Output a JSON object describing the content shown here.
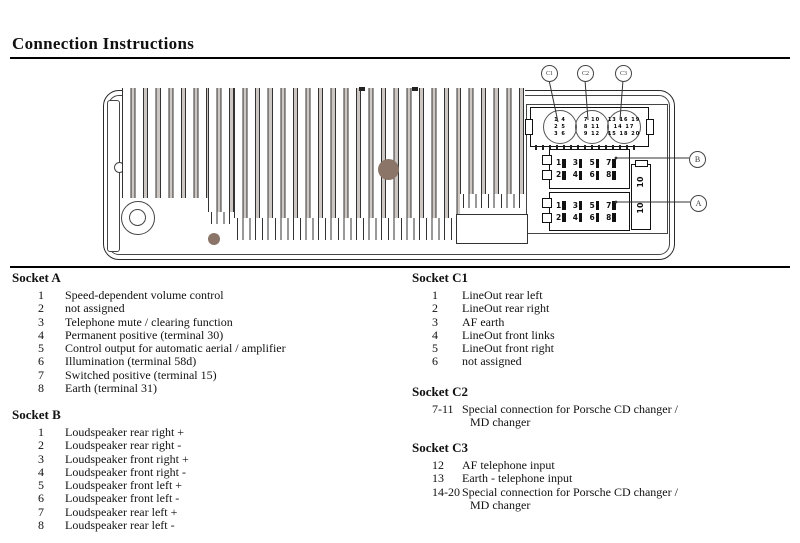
{
  "title": "Connection Instructions",
  "diagram": {
    "callout_c1": "C1",
    "callout_c2": "C2",
    "callout_c3": "C3",
    "callout_b": "B",
    "callout_a": "A",
    "fuse_top": "10",
    "fuse_bottom": "10",
    "socket_b": {
      "row1": [
        "1",
        "3",
        "5",
        "7"
      ],
      "row2": [
        "2",
        "4",
        "6",
        "8"
      ]
    },
    "socket_a": {
      "row1": [
        "1",
        "3",
        "5",
        "7"
      ],
      "row2": [
        "2",
        "4",
        "6",
        "8"
      ]
    },
    "c1": {
      "r1": "1 4",
      "r2": "2 5",
      "r3": "3 6"
    },
    "c2": {
      "r1": "7 10",
      "r2": "8 11",
      "r3": "9 12"
    },
    "c3": {
      "r1": "13 16 19",
      "r2": "14 17",
      "r3": "15 18 20"
    }
  },
  "sections": {
    "socket_a": {
      "title": "Socket A",
      "items": [
        {
          "pin": "1",
          "desc": "Speed-dependent volume control"
        },
        {
          "pin": "2",
          "desc": "not assigned"
        },
        {
          "pin": "3",
          "desc": "Telephone mute / clearing function"
        },
        {
          "pin": "4",
          "desc": "Permanent positive (terminal 30)"
        },
        {
          "pin": "5",
          "desc": "Control output for automatic aerial / amplifier"
        },
        {
          "pin": "6",
          "desc": "Illumination (terminal 58d)"
        },
        {
          "pin": "7",
          "desc": "Switched positive (terminal 15)"
        },
        {
          "pin": "8",
          "desc": "Earth (terminal 31)"
        }
      ]
    },
    "socket_b": {
      "title": "Socket B",
      "items": [
        {
          "pin": "1",
          "desc": "Loudspeaker rear right +"
        },
        {
          "pin": "2",
          "desc": "Loudspeaker rear right -"
        },
        {
          "pin": "3",
          "desc": "Loudspeaker front right +"
        },
        {
          "pin": "4",
          "desc": "Loudspeaker front right -"
        },
        {
          "pin": "5",
          "desc": "Loudspeaker front left +"
        },
        {
          "pin": "6",
          "desc": "Loudspeaker front left -"
        },
        {
          "pin": "7",
          "desc": "Loudspeaker rear left +"
        },
        {
          "pin": "8",
          "desc": "Loudspeaker rear left -"
        }
      ]
    },
    "socket_c1": {
      "title": "Socket C1",
      "items": [
        {
          "pin": "1",
          "desc": "LineOut rear left"
        },
        {
          "pin": "2",
          "desc": "LineOut rear right"
        },
        {
          "pin": "3",
          "desc": "AF earth"
        },
        {
          "pin": "4",
          "desc": "LineOut front links"
        },
        {
          "pin": "5",
          "desc": "LineOut front right"
        },
        {
          "pin": "6",
          "desc": "not assigned"
        }
      ]
    },
    "socket_c2": {
      "title": "Socket C2",
      "items": [
        {
          "pin": "7-11",
          "desc": "Special connection for Porsche CD changer /",
          "desc2": "MD changer"
        }
      ]
    },
    "socket_c3": {
      "title": "Socket C3",
      "items": [
        {
          "pin": "12",
          "desc": "AF telephone input"
        },
        {
          "pin": "13",
          "desc": "Earth - telephone input"
        },
        {
          "pin": "14-20",
          "desc": "Special connection for Porsche CD changer /",
          "desc2": "MD changer"
        }
      ]
    }
  }
}
